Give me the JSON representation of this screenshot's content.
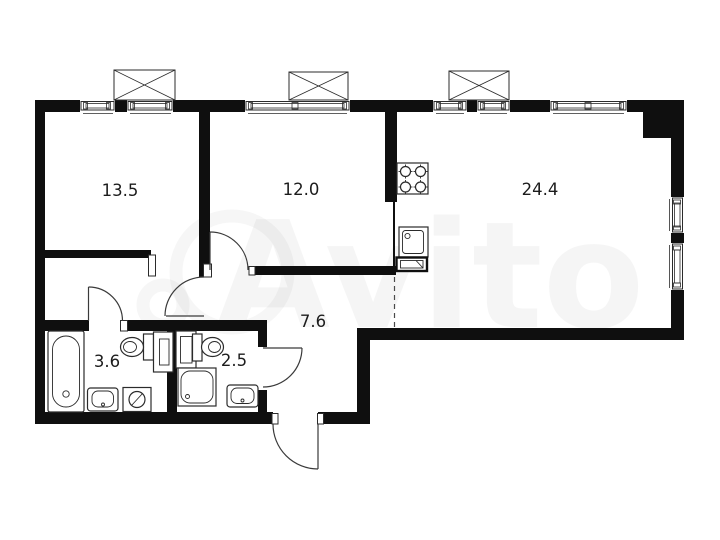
{
  "plan": {
    "watermark_text": "Avito",
    "colors": {
      "wall": "#0f0f0f",
      "line": "#2b2b2b",
      "background": "#ffffff",
      "label": "#1c1c1c"
    },
    "rooms": [
      {
        "id": "room-1",
        "area": "13.5"
      },
      {
        "id": "room-2",
        "area": "12.0"
      },
      {
        "id": "kitchen-living-room",
        "area": "24.4"
      },
      {
        "id": "hallway",
        "area": "7.6"
      },
      {
        "id": "bathroom",
        "area": "3.6"
      },
      {
        "id": "wc",
        "area": "2.5"
      }
    ],
    "fixtures": [
      "stove",
      "kitchen-sink",
      "radiator",
      "bathtub",
      "toilet",
      "storage-cabinet",
      "washbasin",
      "washing-machine",
      "shower-cabin",
      "toilet",
      "storage-cabinet",
      "washbasin"
    ],
    "window_count": 8,
    "balcony_box_count": 3
  }
}
